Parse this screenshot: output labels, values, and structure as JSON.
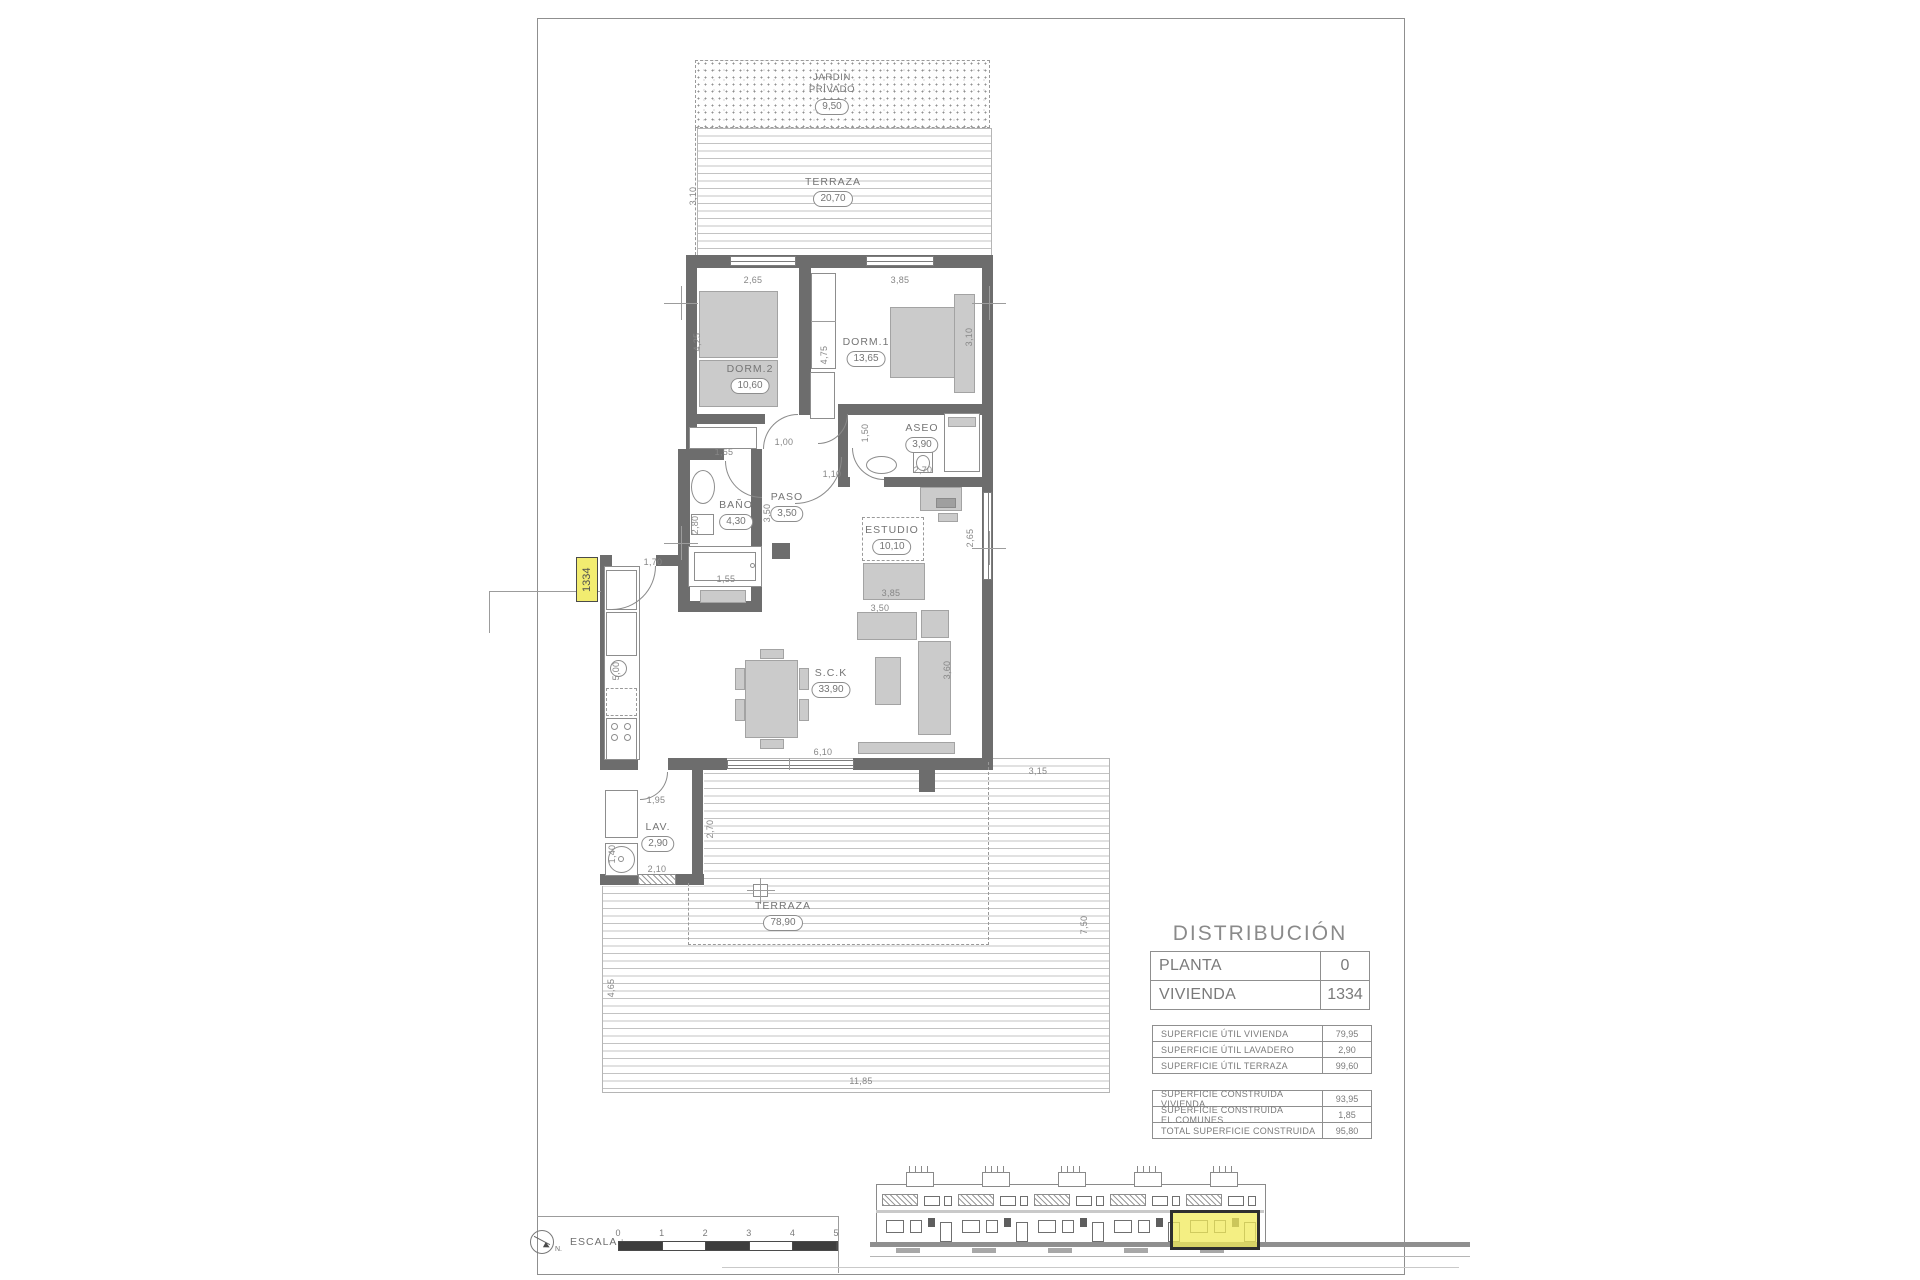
{
  "title_block": {
    "title": "DISTRIBUCIÓN",
    "info_rows": [
      {
        "label": "PLANTA",
        "value": "0"
      },
      {
        "label": "VIVIENDA",
        "value": "1334"
      }
    ],
    "useful_table": [
      {
        "label": "SUPERFICIE ÚTIL VIVIENDA",
        "value": "79,95"
      },
      {
        "label": "SUPERFICIE ÚTIL LAVADERO",
        "value": "2,90"
      },
      {
        "label": "SUPERFICIE ÚTIL TERRAZA",
        "value": "99,60"
      }
    ],
    "built_table": [
      {
        "label": "SUPERFICIE CONSTRUIDA VIVIENDA",
        "value": "93,95"
      },
      {
        "label": "SUPERFICIE CONSTRUIDA EL.COMUNES",
        "value": "1,85"
      },
      {
        "label": "TOTAL SUPERFICIE CONSTRUIDA",
        "value": "95,80"
      }
    ]
  },
  "plan": {
    "unit_tag": "1334",
    "rooms": [
      {
        "id": "jardin",
        "name_lines": [
          "JARDIN",
          "PRIVADO"
        ],
        "area": "9,50",
        "x": 832,
        "y": 72
      },
      {
        "id": "terraza-sup",
        "name_lines": [
          "TERRAZA"
        ],
        "area": "20,70",
        "x": 833,
        "y": 176
      },
      {
        "id": "dorm2",
        "name_lines": [
          "DORM.2"
        ],
        "area": "10,60",
        "x": 750,
        "y": 363
      },
      {
        "id": "dorm1",
        "name_lines": [
          "DORM.1"
        ],
        "area": "13,65",
        "x": 866,
        "y": 336
      },
      {
        "id": "aseo",
        "name_lines": [
          "ASEO"
        ],
        "area": "3,90",
        "x": 922,
        "y": 422
      },
      {
        "id": "bano",
        "name_lines": [
          "BAÑO"
        ],
        "area": "4,30",
        "x": 736,
        "y": 499
      },
      {
        "id": "paso",
        "name_lines": [
          "PASO"
        ],
        "area": "3,50",
        "x": 787,
        "y": 491
      },
      {
        "id": "estudio",
        "name_lines": [
          "ESTUDIO"
        ],
        "area": "10,10",
        "x": 892,
        "y": 524
      },
      {
        "id": "sck",
        "name_lines": [
          "S.C.K"
        ],
        "area": "33,90",
        "x": 831,
        "y": 667
      },
      {
        "id": "lav",
        "name_lines": [
          "LAV."
        ],
        "area": "2,90",
        "x": 658,
        "y": 821
      },
      {
        "id": "terraza-inf",
        "name_lines": [
          "TERRAZA"
        ],
        "area": "78,90",
        "x": 783,
        "y": 900
      }
    ],
    "dims": [
      {
        "t": "3,10",
        "x": 693,
        "y": 196,
        "r": 1
      },
      {
        "t": "2,65",
        "x": 753,
        "y": 280,
        "r": 0
      },
      {
        "t": "3,85",
        "x": 900,
        "y": 280,
        "r": 0
      },
      {
        "t": "4,25",
        "x": 697,
        "y": 342,
        "r": 1
      },
      {
        "t": "4,75",
        "x": 824,
        "y": 355,
        "r": 1
      },
      {
        "t": "3,10",
        "x": 969,
        "y": 337,
        "r": 1
      },
      {
        "t": "1,55",
        "x": 724,
        "y": 452,
        "r": 0
      },
      {
        "t": "1,00",
        "x": 784,
        "y": 442,
        "r": 0
      },
      {
        "t": "1,50",
        "x": 865,
        "y": 433,
        "r": 1
      },
      {
        "t": "2,70",
        "x": 923,
        "y": 470,
        "r": 0
      },
      {
        "t": "1,10",
        "x": 832,
        "y": 474,
        "r": 0
      },
      {
        "t": "3,50",
        "x": 767,
        "y": 513,
        "r": 1
      },
      {
        "t": "2,80",
        "x": 695,
        "y": 525,
        "r": 1
      },
      {
        "t": "1,55",
        "x": 726,
        "y": 579,
        "r": 0
      },
      {
        "t": "2,65",
        "x": 970,
        "y": 538,
        "r": 1
      },
      {
        "t": "3,85",
        "x": 891,
        "y": 593,
        "r": 0
      },
      {
        "t": "3,50",
        "x": 880,
        "y": 608,
        "r": 0
      },
      {
        "t": "3,60",
        "x": 947,
        "y": 670,
        "r": 1
      },
      {
        "t": "1,70",
        "x": 653,
        "y": 562,
        "r": 0
      },
      {
        "t": "5,00",
        "x": 616,
        "y": 671,
        "r": 1
      },
      {
        "t": "6,10",
        "x": 823,
        "y": 752,
        "r": 0
      },
      {
        "t": "1,95",
        "x": 656,
        "y": 800,
        "r": 0
      },
      {
        "t": "2,70",
        "x": 710,
        "y": 829,
        "r": 1
      },
      {
        "t": "1,40",
        "x": 612,
        "y": 854,
        "r": 1
      },
      {
        "t": "2,10",
        "x": 657,
        "y": 869,
        "r": 0
      },
      {
        "t": "3,15",
        "x": 1038,
        "y": 771,
        "r": 0
      },
      {
        "t": "7,50",
        "x": 1084,
        "y": 925,
        "r": 1
      },
      {
        "t": "4,65",
        "x": 611,
        "y": 988,
        "r": 1
      },
      {
        "t": "11,85",
        "x": 861,
        "y": 1081,
        "r": 0
      }
    ]
  },
  "footer": {
    "scale_label": "ESCALA :",
    "north_label": "N.",
    "ticks": [
      "0",
      "1",
      "2",
      "3",
      "4",
      "5"
    ]
  }
}
